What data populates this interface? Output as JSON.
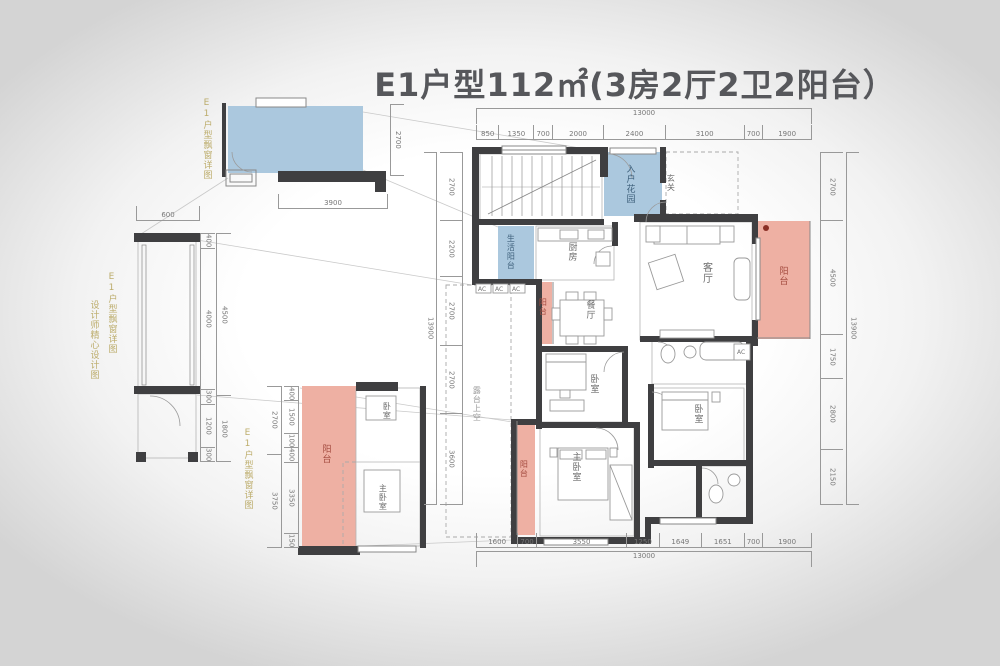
{
  "title": "E1户型112㎡(3房2厅2卫2阳台）",
  "colors": {
    "wall": "#3f3f41",
    "balcony_fill": "#eeb0a3",
    "garden_fill": "#abc8de",
    "balcony_label": "#a34a3e",
    "garden_label": "#3f617c",
    "watermark_gold": "#b3a054",
    "dim_line": "#999999",
    "background_vignette": "#d4d4d4"
  },
  "rooms": {
    "entry_garden": "入户花园",
    "hallway": "玄关",
    "kitchen": "厨房",
    "service_balcony": "生活阳台",
    "living": "客厅",
    "dining": "餐厅",
    "balcony": "阳台",
    "bedroom": "卧室",
    "master_bedroom": "主卧室",
    "terrace_void": "露台上空",
    "ac_unit": "AC"
  },
  "dims": {
    "plan_top": [
      "850",
      "1350",
      "700",
      "2000",
      "2400",
      "3100",
      "700",
      "1900"
    ],
    "plan_top_total": [
      "13000"
    ],
    "plan_bottom": [
      "1600",
      "700",
      "3550",
      "1250",
      "1649",
      "1651",
      "700",
      "1900"
    ],
    "plan_bottom_total": [
      "13000"
    ],
    "plan_left": [
      "2700",
      "2200",
      "2700",
      "2700",
      "3600"
    ],
    "plan_left_total": [
      "13900"
    ],
    "plan_right": [
      "2700",
      "4500",
      "1750",
      "2800",
      "2150"
    ],
    "plan_right_total": [
      "13900"
    ],
    "detail_a_width": [
      "3900"
    ],
    "detail_a_height": [
      "2700"
    ],
    "detail_b_top": [
      "600"
    ],
    "detail_b_inner": [
      "400",
      "4000",
      "300",
      "1200",
      "300"
    ],
    "detail_b_outer": [
      "4500",
      "1800"
    ],
    "detail_c_inner": [
      "400",
      "1500",
      "100",
      "400",
      "3350",
      "150"
    ],
    "detail_c_outer": [
      "2700",
      "3750"
    ]
  },
  "watermarks": {
    "detail_label": "E1户型飘窗详图",
    "designer_label": "设计师精心设计图"
  }
}
